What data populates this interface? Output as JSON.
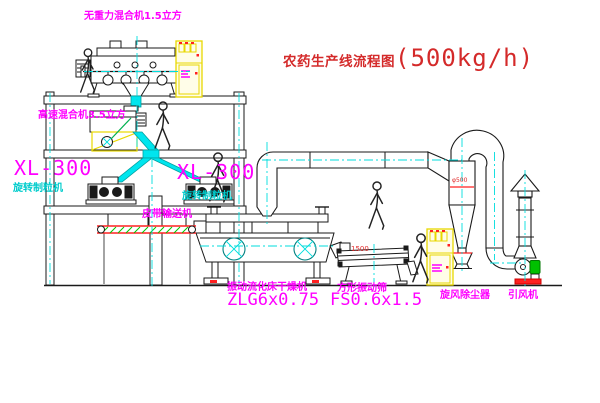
{
  "title": {
    "cn": "农药生产线流程图",
    "capacity": "(500kg/h)"
  },
  "labels": {
    "gravity_mixer": "无重力混合机1.5立方",
    "high_speed_mixer": "高速混合机3.5立方",
    "granulator_left_model": "XL-300",
    "granulator_left_name": "旋转制粒机",
    "granulator_right_model": "XL-300",
    "granulator_right_name": "旋转制粒机",
    "belt_conveyor": "皮带输送机",
    "dryer_name": "振动流化床干燥机",
    "dryer_model": "ZLG6x0.75",
    "screen_name": "方形振动筛",
    "screen_model": "FS0.6x1.5",
    "cyclone": "旋风除尘器",
    "fan": "引风机",
    "dim_screen": "1500",
    "dim_cyclone": "φ500"
  },
  "colors": {
    "title_red": "#d42a2a",
    "label_magenta": "#ff00ff",
    "label_cyan": "#00cccc",
    "centerline_cyan": "#00dddd",
    "chute_cyan": "#00e5ee",
    "cabinet_yellow": "#e8d800",
    "motor_green": "#00c000",
    "conveyor_red": "#ff2020",
    "hatch_green": "#00c800",
    "line_black": "#1a1a1a"
  }
}
